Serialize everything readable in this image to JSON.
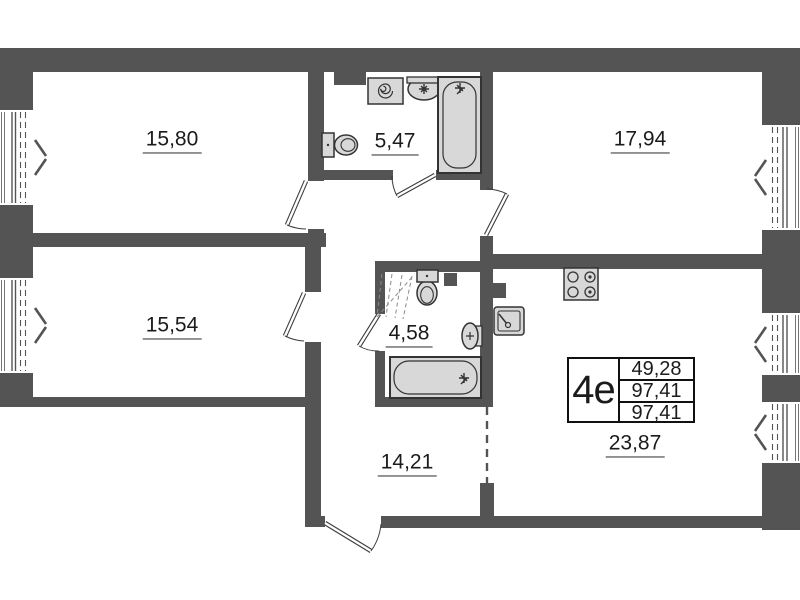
{
  "plan_type": {
    "code": "4е",
    "area_rows": [
      "49,28",
      "97,41",
      "97,41"
    ]
  },
  "rooms": {
    "bedroom_top_left": {
      "label": "15,80"
    },
    "bathroom_top": {
      "label": "5,47"
    },
    "bedroom_top_right": {
      "label": "17,94"
    },
    "bedroom_mid_left": {
      "label": "15,54"
    },
    "bathroom_mid": {
      "label": "4,58"
    },
    "hallway": {
      "label": "14,21"
    },
    "kitchen_living": {
      "label": "23,87"
    }
  },
  "fixtures": {
    "bathroom_top": [
      "washing-machine",
      "sink",
      "bathtub",
      "toilet"
    ],
    "bathroom_mid": [
      "toilet",
      "sink",
      "bathtub",
      "folding-screen"
    ],
    "kitchen_living": [
      "stove",
      "kitchen-sink"
    ]
  },
  "colors": {
    "wall": "#545454",
    "fixture_fill": "#d8d8d8",
    "fixture_stroke": "#333333",
    "text": "#1b1b1b"
  }
}
